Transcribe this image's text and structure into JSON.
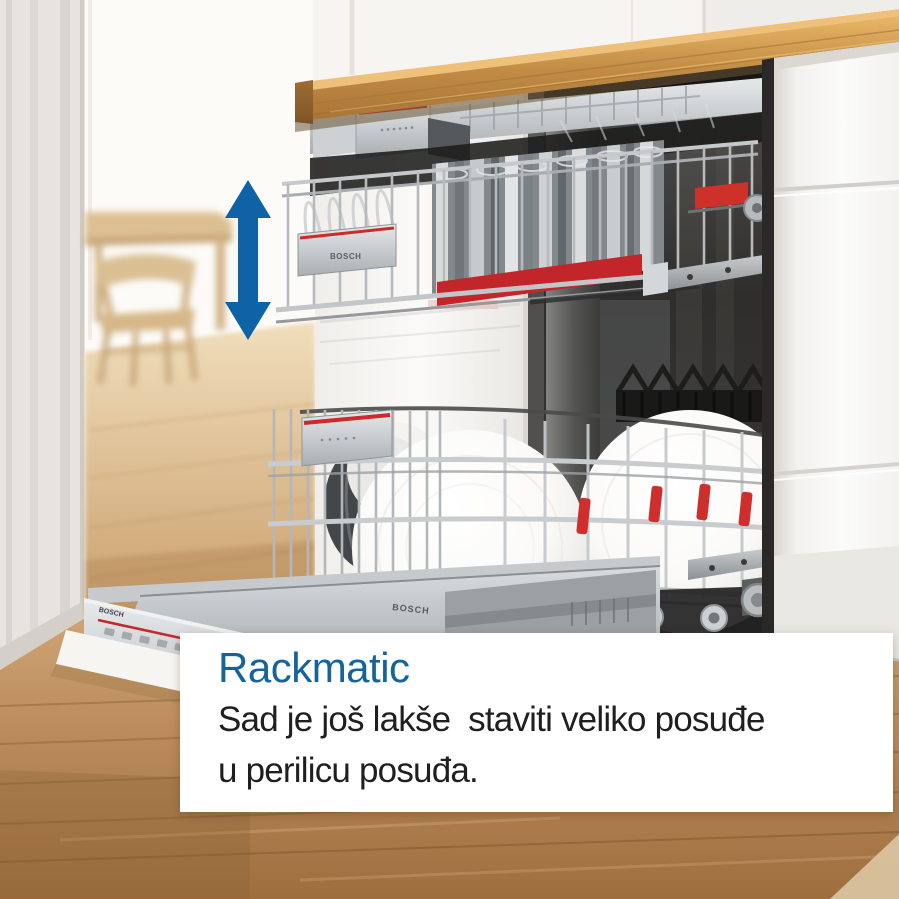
{
  "caption": {
    "title": "Rackmatic",
    "line1": "Sad je još lakše  staviti veliko posuđe",
    "line2": "u perilicu posuđa."
  },
  "branding": {
    "logo_text": "BOSCH"
  },
  "icons": {
    "height_arrow": "vertical-double-arrow-icon"
  },
  "colors": {
    "brand_blue": "#14639E",
    "arrow_blue": "#0E63A6",
    "accent_red": "#CC2A2C",
    "wood_counter": "#C08A4A",
    "wood_floor": "#B48655",
    "cabinet_white": "#F7F6F4",
    "panel_white": "#FFFFFF",
    "text_dark": "#1F1F1F"
  }
}
